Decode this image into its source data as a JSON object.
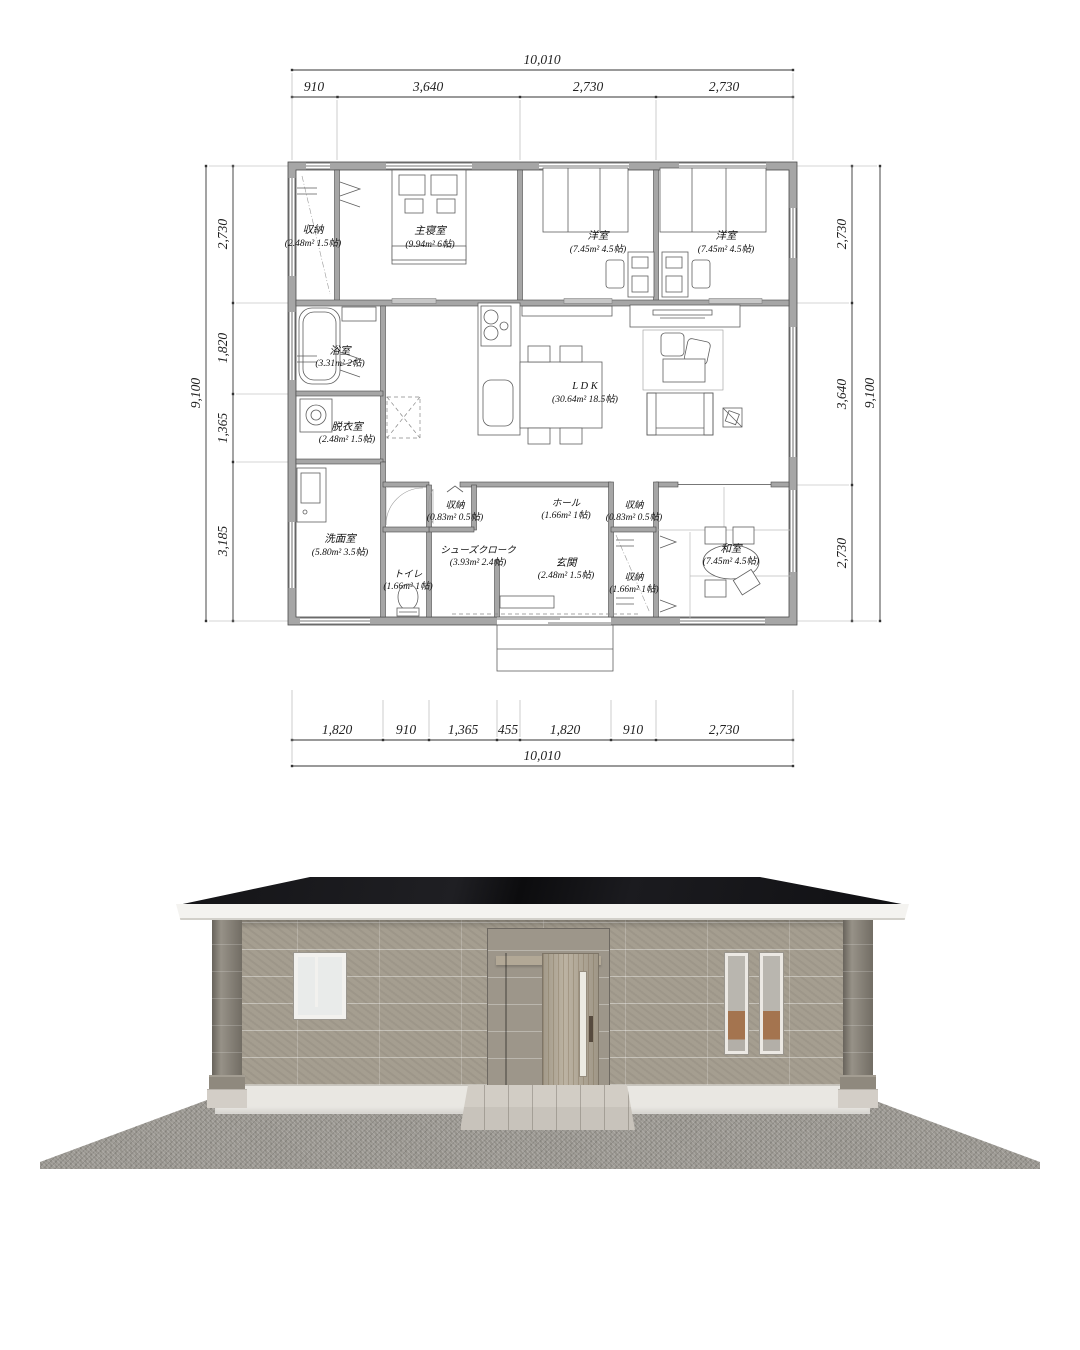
{
  "plan": {
    "dims_top": {
      "overall": "10,010",
      "segments": [
        "910",
        "3,640",
        "2,730",
        "2,730"
      ]
    },
    "dims_bottom": {
      "overall": "10,010",
      "segments": [
        "1,820",
        "910",
        "1,365",
        "455",
        "1,820",
        "910",
        "2,730"
      ]
    },
    "dims_left": {
      "overall": "9,100",
      "segments": [
        "2,730",
        "1,820",
        "1,365",
        "3,185"
      ]
    },
    "dims_right": {
      "overall": "9,100",
      "segments": [
        "2,730",
        "3,640",
        "2,730"
      ]
    },
    "rooms": {
      "closet_nw": {
        "name": "収納",
        "area": "(2.48m² 1.5帖)"
      },
      "master_bedroom": {
        "name": "主寝室",
        "area": "(9.94m² 6帖)"
      },
      "western_room_1": {
        "name": "洋室",
        "area": "(7.45m² 4.5帖)"
      },
      "western_room_2": {
        "name": "洋室",
        "area": "(7.45m² 4.5帖)"
      },
      "bathroom": {
        "name": "浴室",
        "area": "(3.31m² 2帖)"
      },
      "ldk": {
        "name": "L D K",
        "area": "(30.64m² 18.5帖)"
      },
      "dressing_room": {
        "name": "脱衣室",
        "area": "(2.48m² 1.5帖)"
      },
      "washroom": {
        "name": "洗面室",
        "area": "(5.80m² 3.5帖)"
      },
      "closet_hall_a": {
        "name": "収納",
        "area": "(0.83m² 0.5帖)"
      },
      "hall": {
        "name": "ホール",
        "area": "(1.66m² 1帖)"
      },
      "closet_hall_b": {
        "name": "収納",
        "area": "(0.83m² 0.5帖)"
      },
      "shoe_closet": {
        "name": "シューズクローク",
        "area": "(3.93m² 2.4帖)"
      },
      "entrance": {
        "name": "玄関",
        "area": "(2.48m² 1.5帖)"
      },
      "toilet": {
        "name": "トイレ",
        "area": "(1.66m² 1帖)"
      },
      "closet_entry": {
        "name": "収納",
        "area": "(1.66m² 1帖)"
      },
      "japanese_room": {
        "name": "和室",
        "area": "(7.45m² 4.5帖)"
      }
    },
    "wall_color": "#a6a6a6",
    "line_color": "#444444"
  },
  "elevation": {
    "colors": {
      "roof": "#141417",
      "fascia": "#f4f3f0",
      "wall": "#a59e90",
      "pillar": "#8b857a",
      "plinth": "#e9e7e2",
      "door_wood": "#b6ac9a",
      "ground_gravel": "#9e9b95",
      "step": "#cdc8c0",
      "window_glass": "#e9ebea",
      "window_frame": "#f2f1ee",
      "blind": "#a4744f"
    }
  }
}
